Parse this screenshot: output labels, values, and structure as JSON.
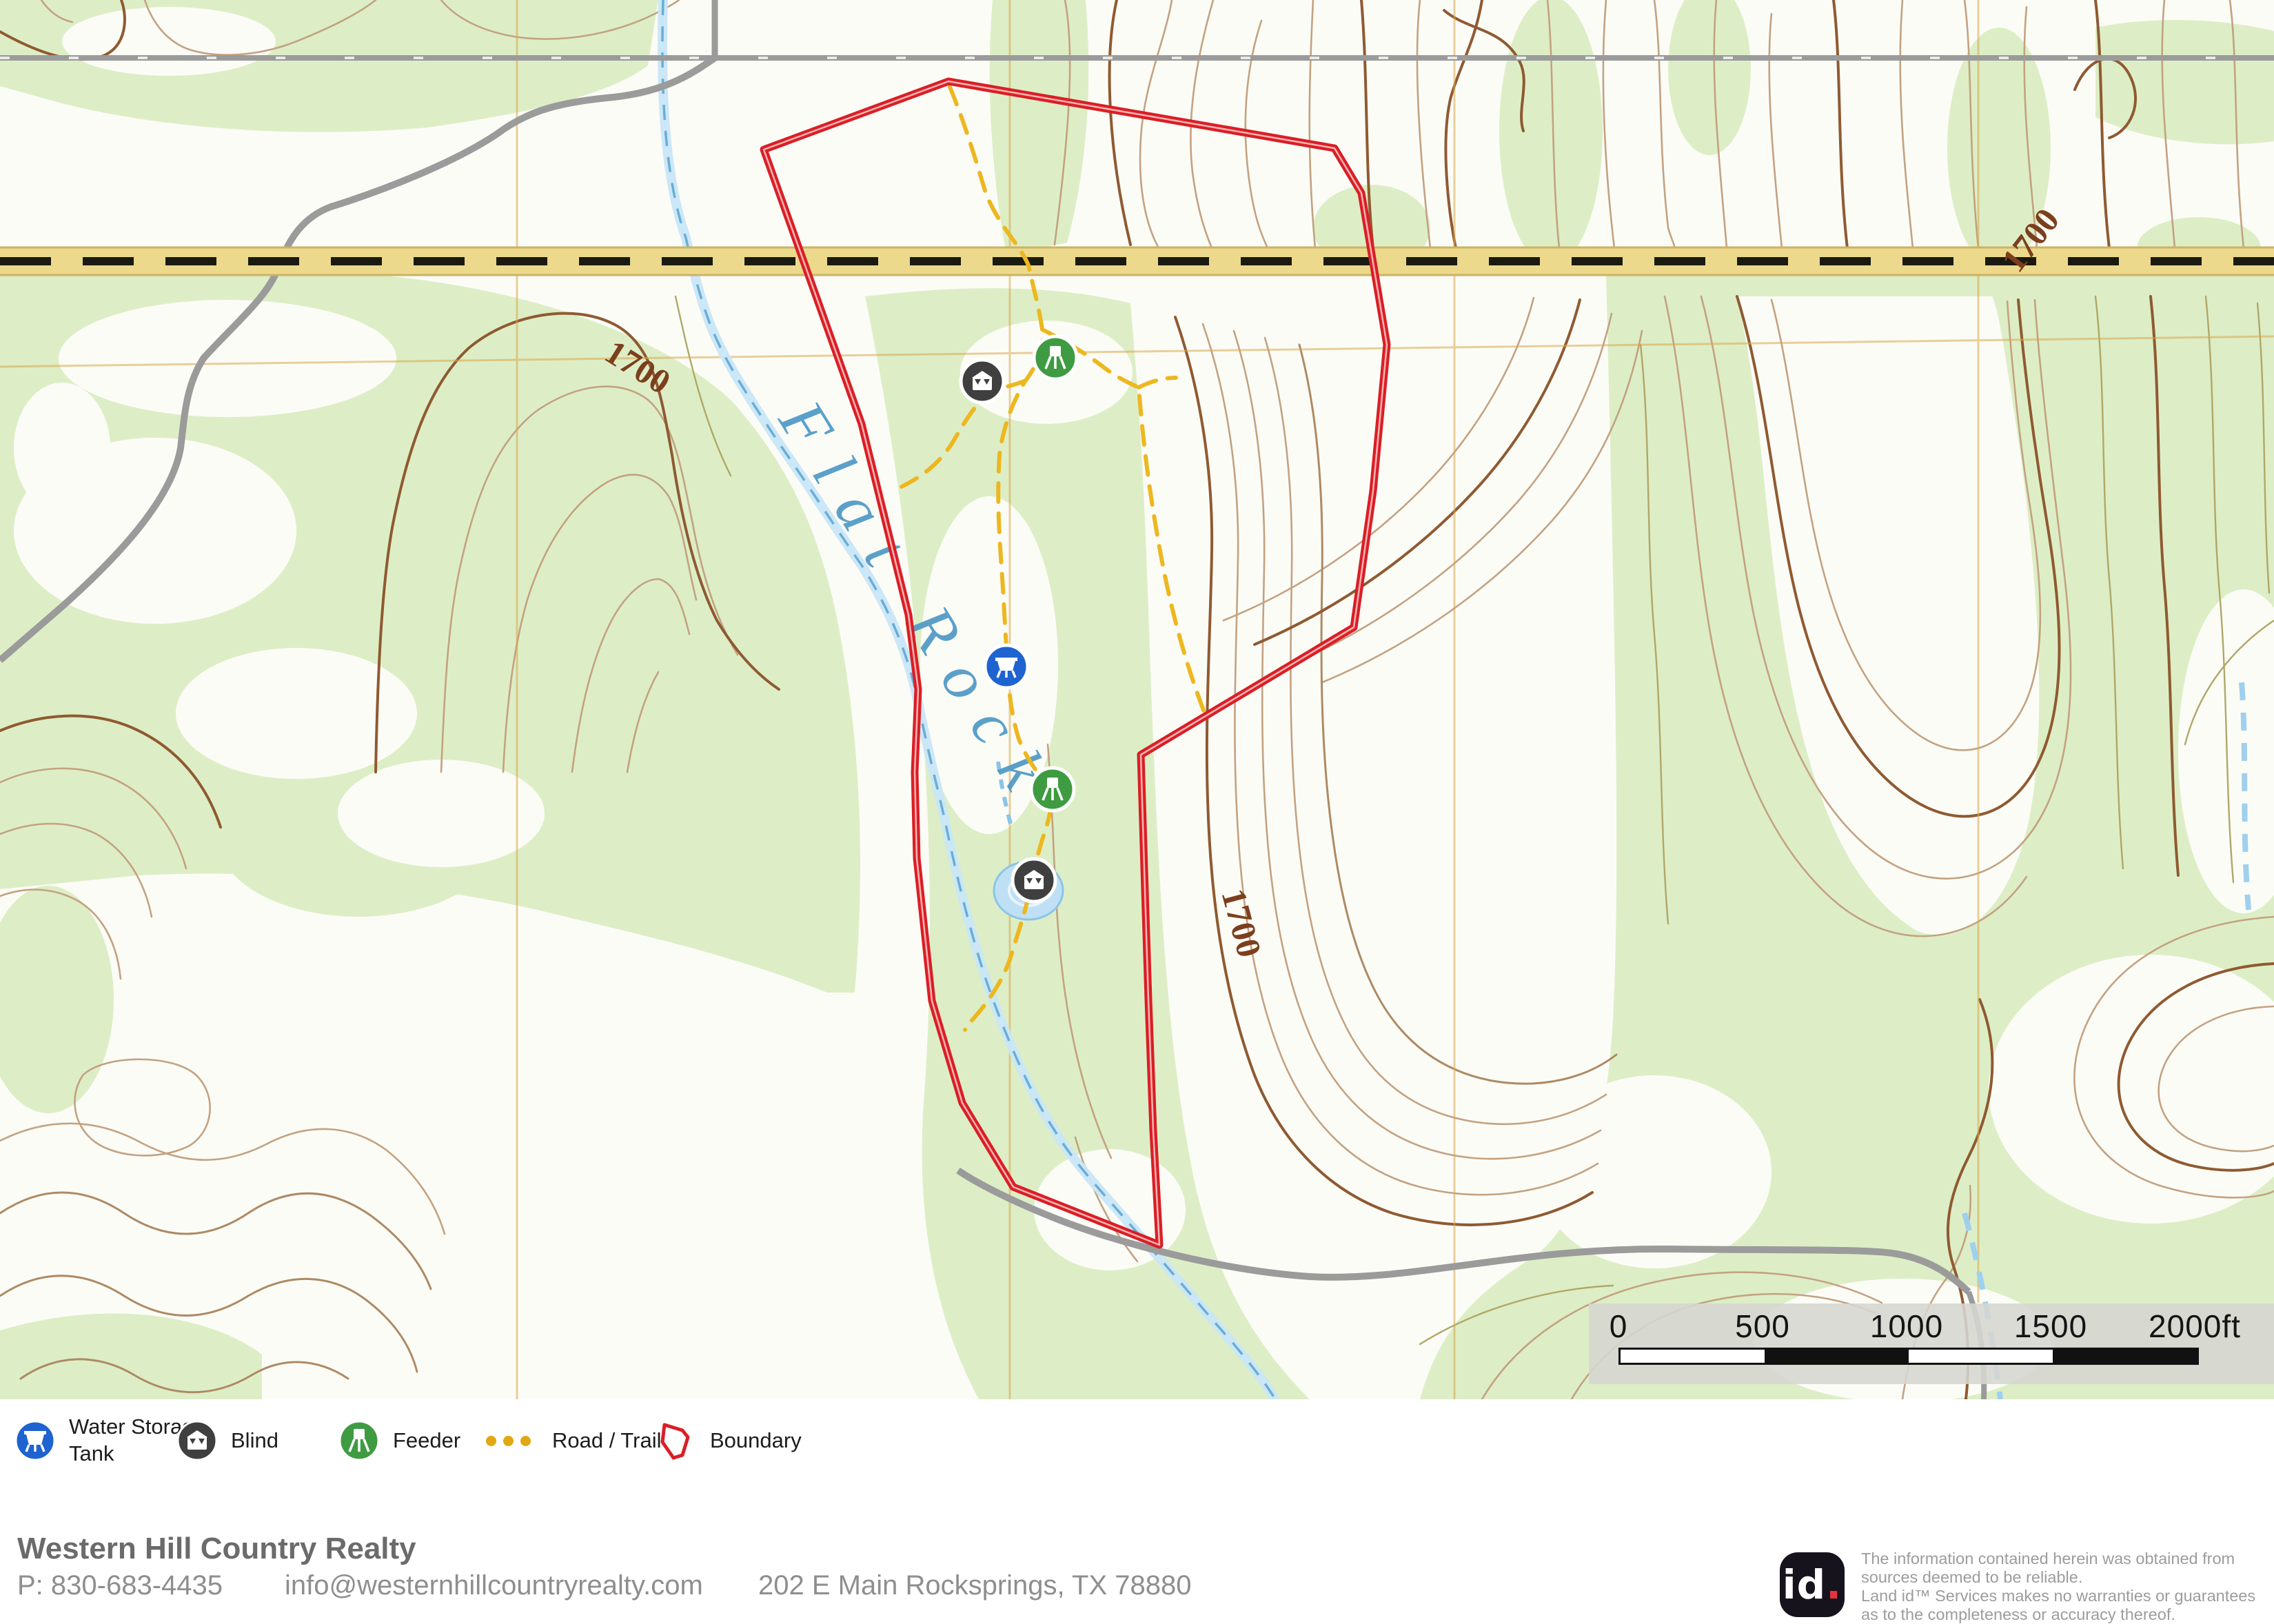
{
  "map": {
    "contour_labels": [
      "1700",
      "1700",
      "1700"
    ],
    "creek_label": "Flat Rock",
    "scale_labels": [
      "0",
      "500",
      "1000",
      "1500",
      "2000ft"
    ],
    "markers": [
      {
        "type": "blind"
      },
      {
        "type": "feeder"
      },
      {
        "type": "water-storage-tank"
      },
      {
        "type": "feeder"
      },
      {
        "type": "blind"
      }
    ]
  },
  "legend": {
    "items": [
      {
        "icon": "water-storage-tank-icon",
        "label": "Water Storage\nTank"
      },
      {
        "icon": "blind-icon",
        "label": "Blind"
      },
      {
        "icon": "feeder-icon",
        "label": "Feeder"
      },
      {
        "icon": "road-trail-icon",
        "label": "Road / Trail"
      },
      {
        "icon": "boundary-icon",
        "label": "Boundary"
      }
    ]
  },
  "footer": {
    "company": "Western Hill Country Realty",
    "phone": "P: 830-683-4435",
    "email": "info@westernhillcountryrealty.com",
    "address": "202 E Main Rocksprings, TX 78880"
  },
  "attribution": {
    "logo_text": "id",
    "logo_dot": ".",
    "disclaimer": "The information contained herein was obtained from\nsources deemed to be reliable.\n Land id™ Services makes no warranties or guarantees\nas to the completeness or accuracy thereof."
  },
  "colors": {
    "boundary_red": "#d91f26",
    "trail_yellow": "#edb71f",
    "marker_blue": "#1e63d0",
    "marker_green": "#3f9b42",
    "marker_dark": "#3f3f3f",
    "vegetation_green": "#ddeec6",
    "contour_brown": "#8f5a31",
    "highway_tan": "#ecd98c",
    "creek_blue": "#c9e6f7"
  }
}
